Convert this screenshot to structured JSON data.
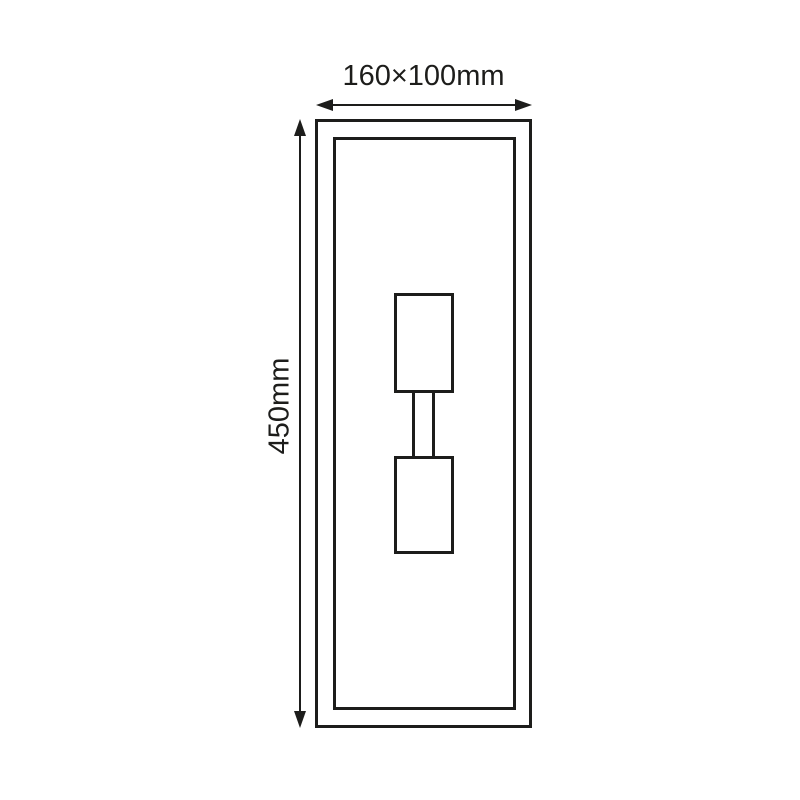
{
  "colors": {
    "line": "#1d1d1b",
    "background": "#ffffff"
  },
  "dimensions": {
    "width_label": "160×100mm",
    "height_label": "450mm"
  }
}
